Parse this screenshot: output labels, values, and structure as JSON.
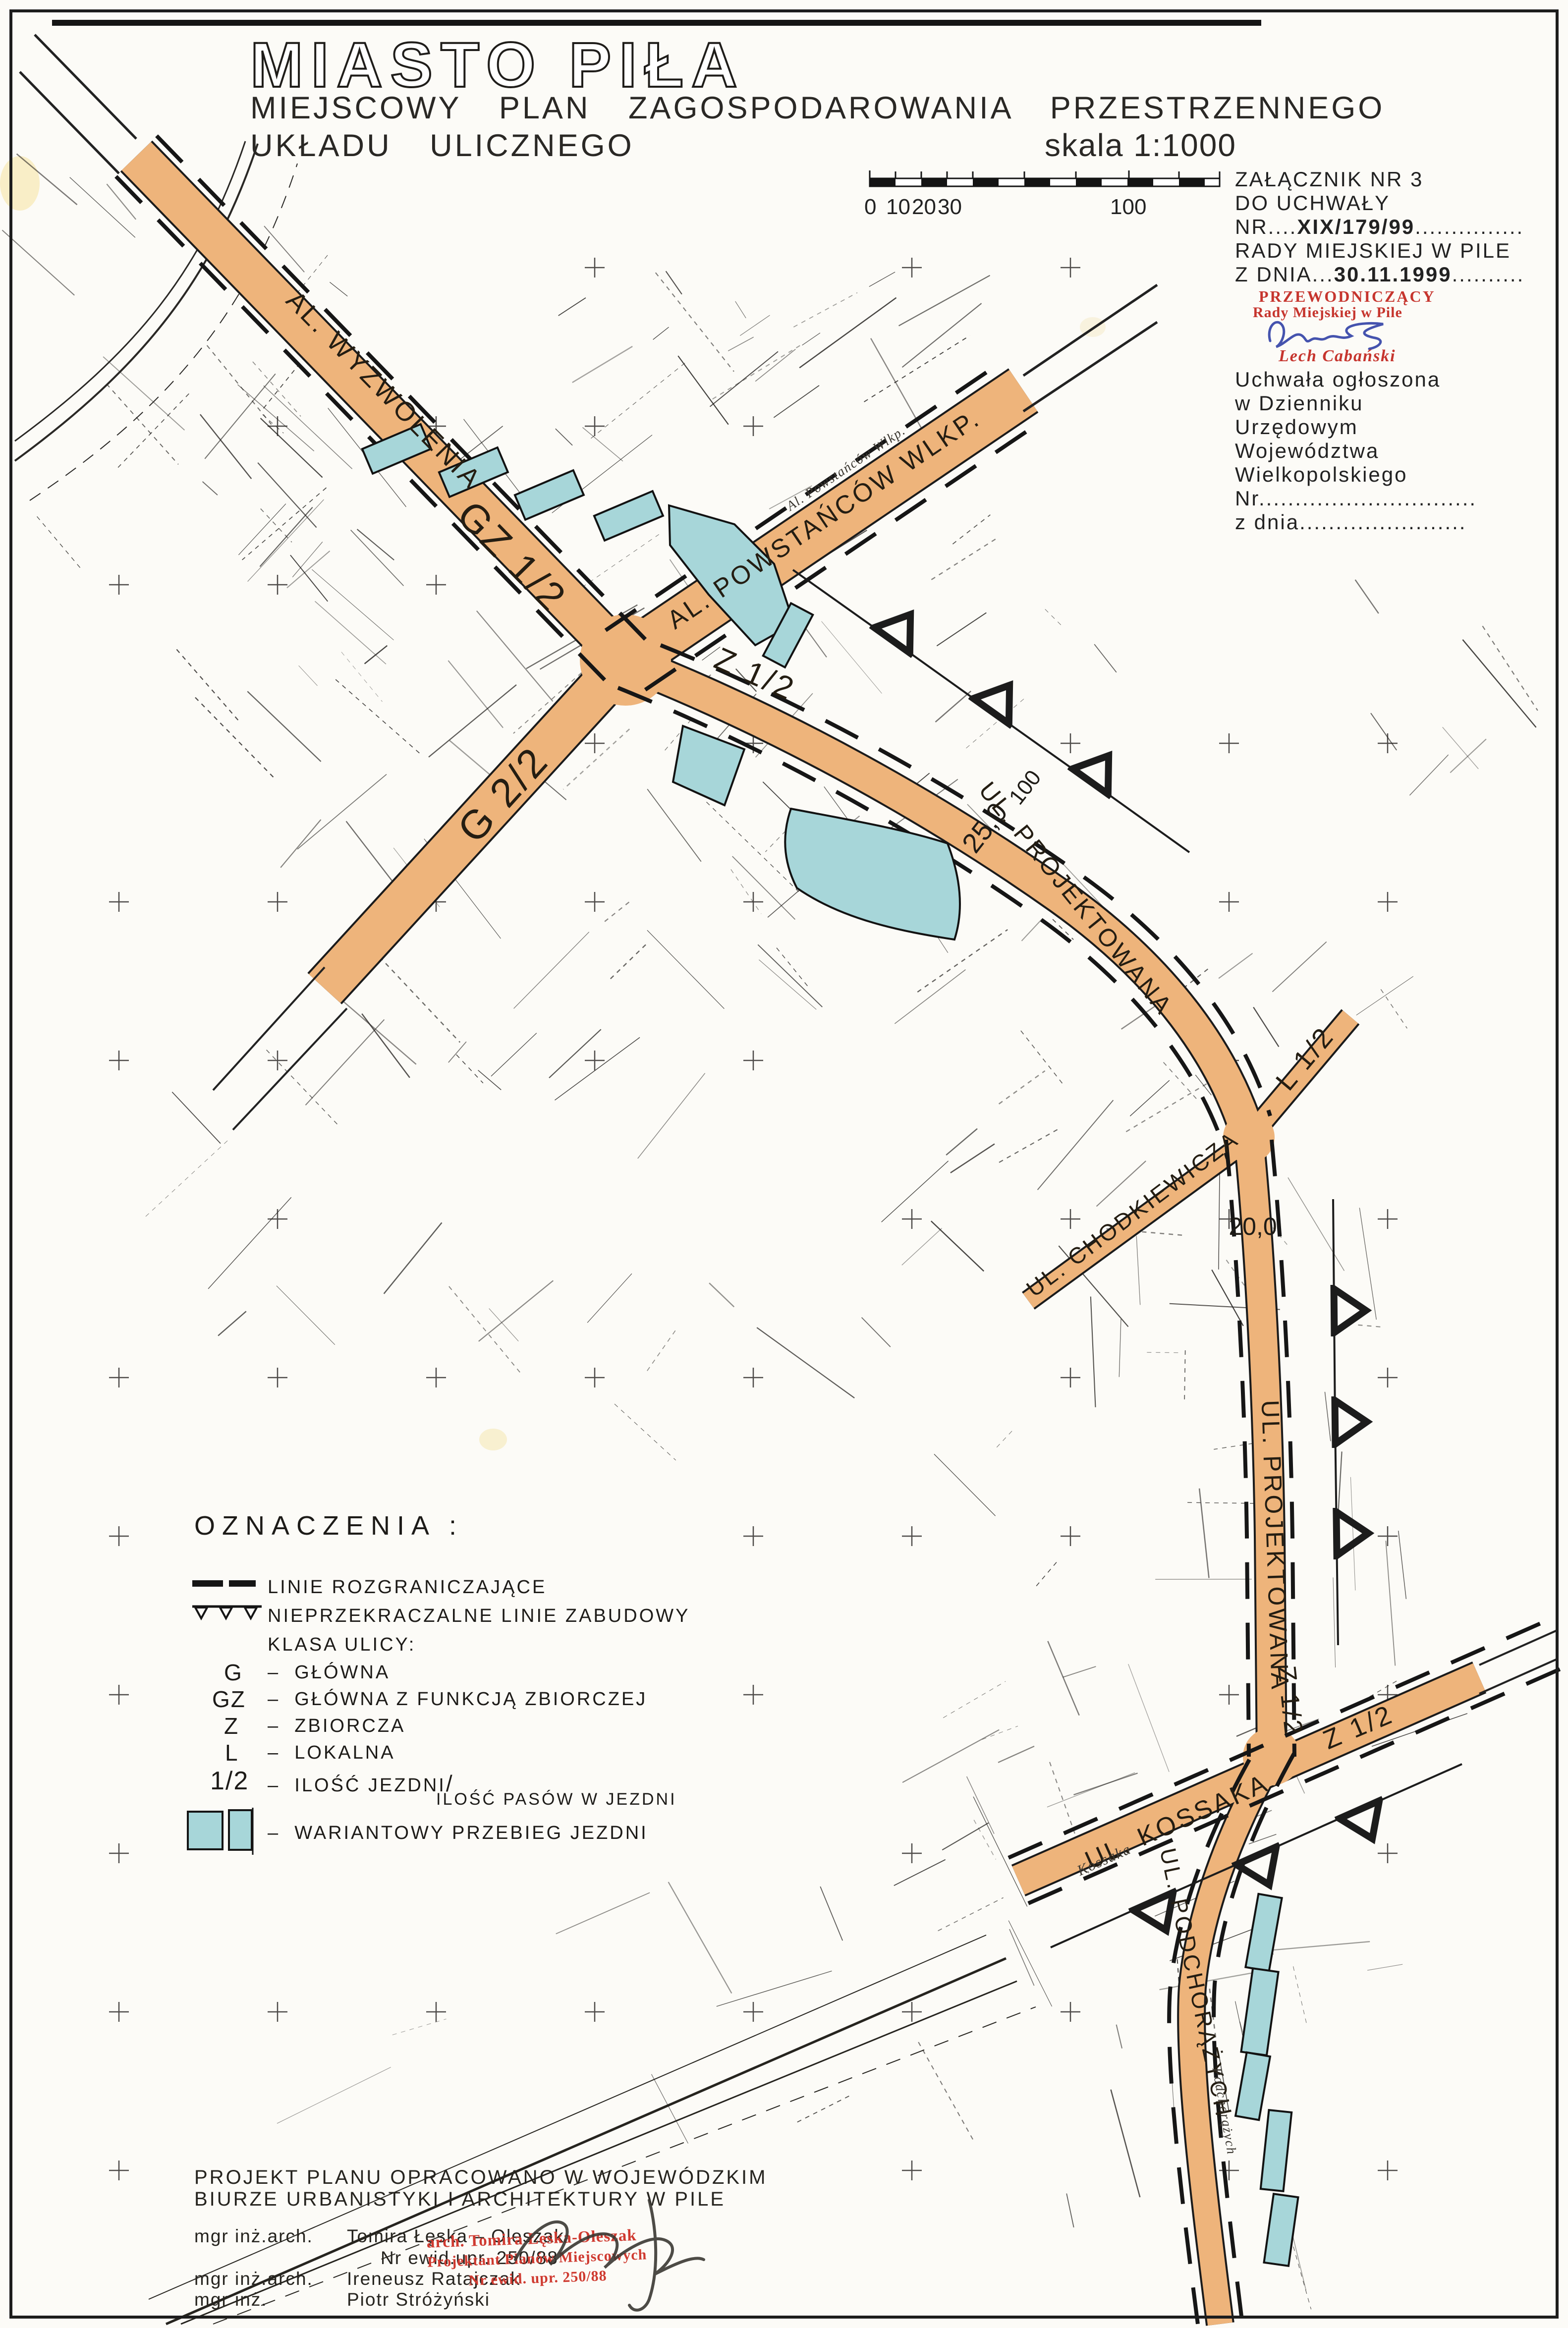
{
  "page": {
    "title": "MIASTO PIŁA",
    "subtitle_line1": "MIEJSCOWY PLAN ZAGOSPODAROWANIA PRZESTRZENNEGO",
    "subtitle_line2": "UKŁADU ULICZNEGO",
    "scale_text": "skala 1:1000"
  },
  "scalebar": {
    "t0": "0",
    "t10": "10",
    "t20": "20",
    "t30": "30",
    "t100": "100"
  },
  "annotation": {
    "line1": "ZAŁĄCZNIK NR 3",
    "line2": "DO UCHWAŁY",
    "nr_label": "NR....",
    "nr_value": "XIX/179/99",
    "nr_dots": "...............",
    "line4": "RADY MIEJSKIEJ W PILE",
    "dnia_label": "Z DNIA...",
    "dnia_value": "30.11.1999",
    "dnia_dots": "..........",
    "stamp_line1": "PRZEWODNICZĄCY",
    "stamp_line2": "Rady Miejskiej w Pile",
    "stamp_name": "Lech Cabański",
    "pub1": "Uchwała ogłoszona",
    "pub2": "w Dzienniku",
    "pub3": "Urzędowym",
    "pub4": "Województwa",
    "pub5": "Wielkopolskiego",
    "pub6": "Nr..............................",
    "pub7": "z dnia......................."
  },
  "legend": {
    "heading": "OZNACZENIA :",
    "dash": "–",
    "item_lines": "LINIE ROZGRANICZAJĄCE",
    "item_building": "NIEPRZEKRACZALNE LINIE ZABUDOWY",
    "klasa": "KLASA ULICY:",
    "g_key": "G",
    "g_val": "GŁÓWNA",
    "gz_key": "GZ",
    "gz_val": "GŁÓWNA Z FUNKCJĄ ZBIORCZEJ",
    "z_key": "Z",
    "z_val": "ZBIORCZA",
    "l_key": "L",
    "l_val": "LOKALNA",
    "frac_key": "1/2",
    "frac_val1": "ILOŚĆ JEZDNI",
    "frac_val2": "ILOŚĆ PASÓW W JEZDNI",
    "variant_val": "WARIANTOWY PRZEBIEG JEZDNI"
  },
  "credits": {
    "line1": "PROJEKT PLANU OPRACOWANO W WOJEWÓDZKIM",
    "line2": "BIURZE URBANISTYKI I ARCHITEKTURY W PILE",
    "role1": "mgr inż.arch.",
    "name1": "Tomira Łęska – Oleszak",
    "cert1": "Nr ewid.upr. 250/88",
    "role2": "mgr inż.arch.",
    "name2": "Ireneusz Ratajczak",
    "role3": "mgr inż.",
    "name3": "Piotr Stróżyński",
    "stamp1": "arch. Tomira Łęska-Oleszak",
    "stamp2": "Projektant Planów Miejscowych",
    "stamp3": "Nr ewid. upr. 250/88"
  },
  "map": {
    "labels": {
      "wyzwolenia": "AL. WYZWOLENIA",
      "gz12": "GZ 1/2",
      "g22": "G 2/2",
      "powstancow": "AL. POWSTAŃCÓW WLKP.",
      "powstancow_small": "Al. Powstańców Wlkp.",
      "z12_a": "Z 1/2",
      "dim_25": "25,0",
      "dim_100": "100",
      "projektowana_a": "UL. PROJEKTOWANA",
      "l12": "L 1/2",
      "chodkiewicza": "UL. CHODKIEWICZA",
      "dim_20": "20,0",
      "projektowana_b": "UL. PROJEKTOWANA",
      "z12_b": "Z 1/2",
      "kossaka": "UL. KOSSAKA",
      "kossaka_small": "Kossaka",
      "z12_c": "Z 1/2",
      "podchorazych": "UL. PODCHORĄŻYCH",
      "podchorazych_small": "Podchorążych"
    },
    "colors": {
      "road": "#eeb47b",
      "variant": "#a7d6d9",
      "stamp_red": "#c6352e",
      "signature_blue": "#4553ae"
    }
  }
}
